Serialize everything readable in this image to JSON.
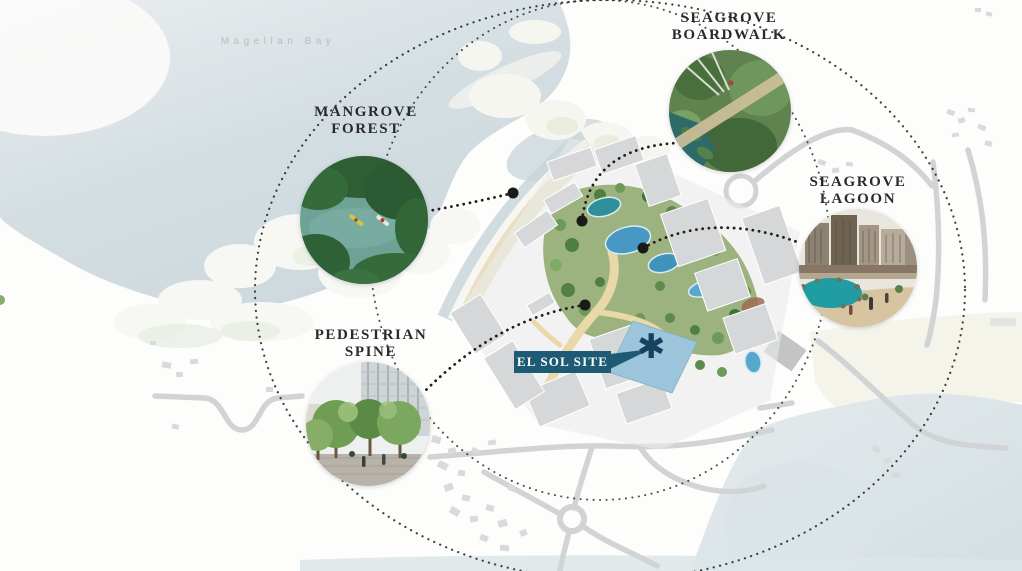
{
  "canvas": {
    "width": 1022,
    "height": 571
  },
  "map": {
    "bay_label": "Magellan Bay",
    "callouts": [
      {
        "id": "mangrove-forest",
        "label": "MANGROVE\nFOREST"
      },
      {
        "id": "seagrove-boardwalk",
        "label": "SEAGROVE\nBOARDWALK"
      },
      {
        "id": "seagrove-lagoon",
        "label": "SEAGROVE\nLAGOON"
      },
      {
        "id": "pedestrian-spine",
        "label": "PEDESTRIAN\nSPINE"
      }
    ],
    "site_tag": {
      "label": "EL SOL SITE",
      "marker": "✱"
    },
    "colors": {
      "tag_background": "#1d5b74",
      "tag_text": "#ffffff",
      "marker": "#16425f",
      "label_text": "#2a2a2a",
      "bay_label_text": "#b7bdc1",
      "bay_water": "#ccd8dd",
      "sea_water": "#d8e1e5",
      "site_fill": "#9cc4da",
      "connector_dots": "#1f1f1f"
    }
  }
}
